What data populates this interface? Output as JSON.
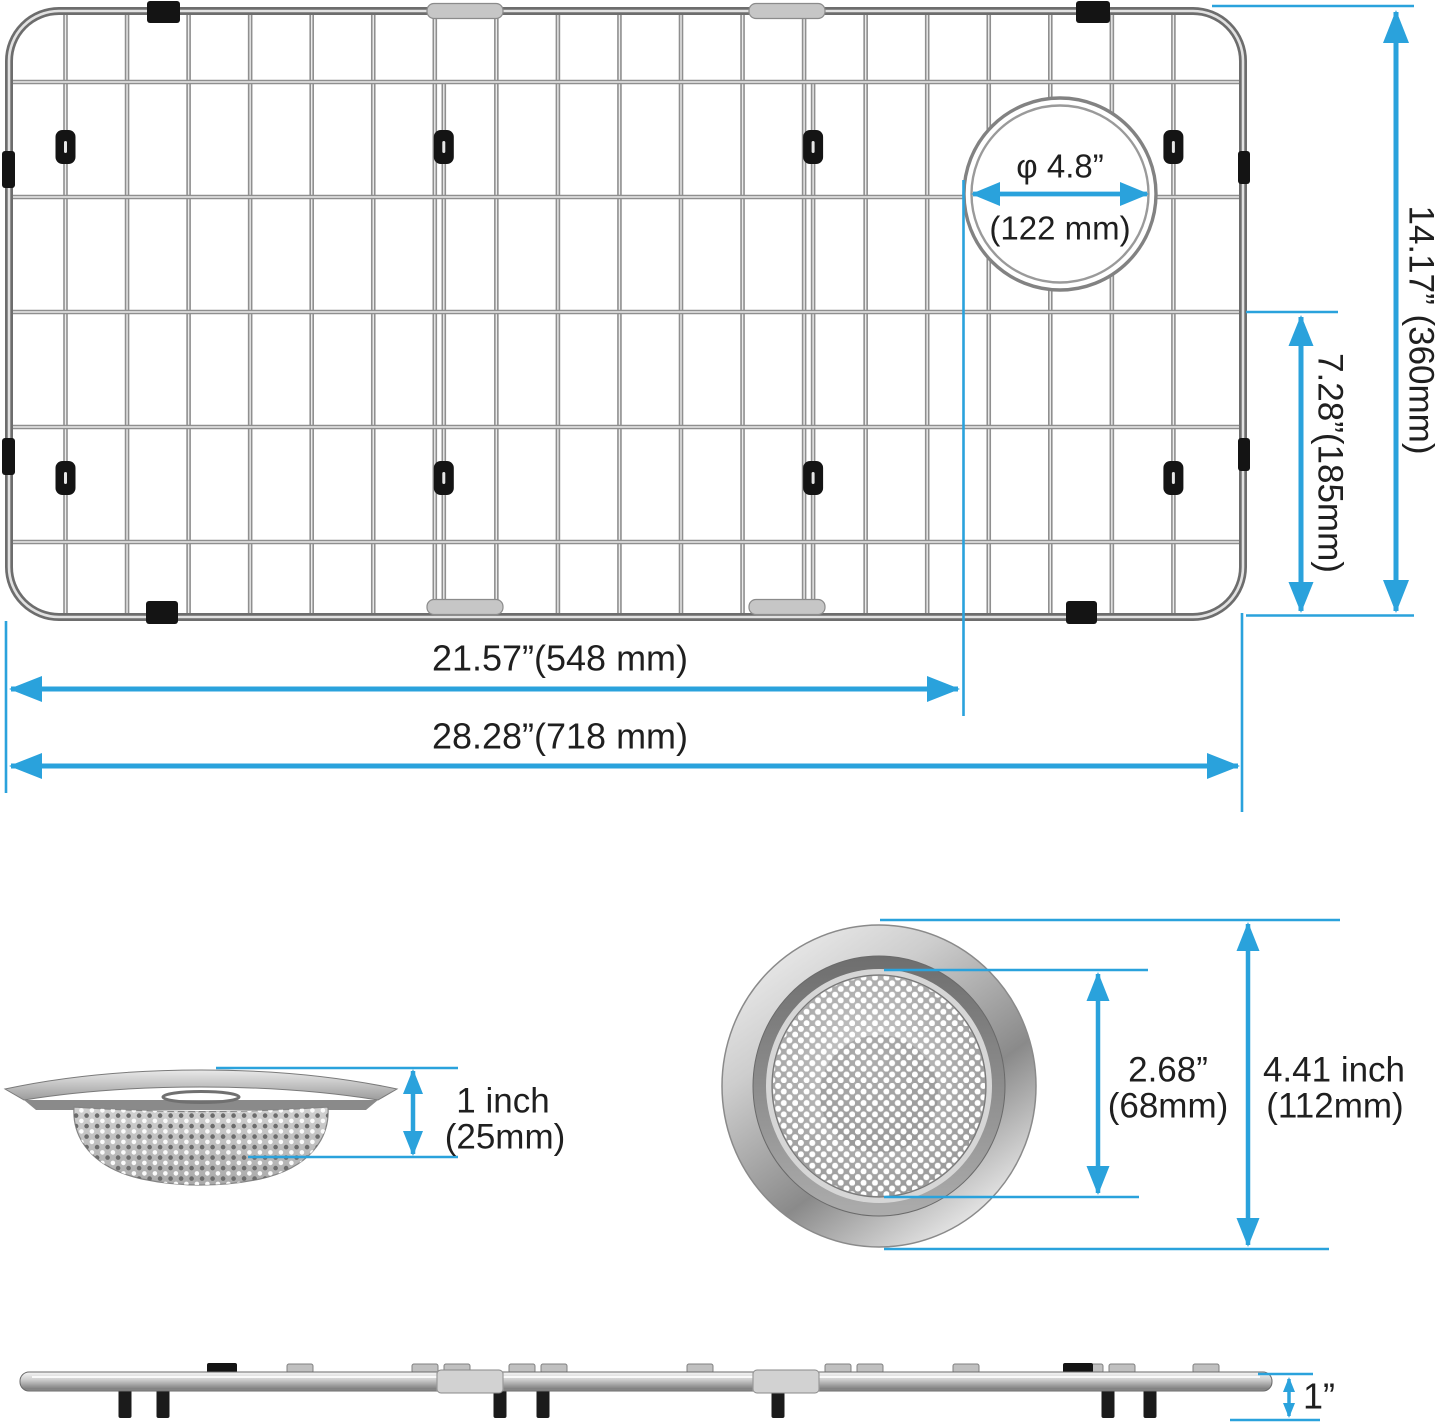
{
  "colors": {
    "dimension_blue": "#2AA2DC",
    "label_text": "#1f1f1f",
    "metal_gray": "#8f8f8f",
    "clip_black": "#141414"
  },
  "grid_view": {
    "hole_diameter_inch": "φ 4.8”",
    "hole_diameter_mm": "(122 mm)",
    "height": "14.17” (360mm)",
    "inner_height": "7.28”(185mm)",
    "drain_offset": "21.57”(548 mm)",
    "width": "28.28”(718 mm)"
  },
  "strainer_side": {
    "height_inch": "1 inch",
    "height_mm": "(25mm)"
  },
  "strainer_top": {
    "mesh_diameter_inch": "2.68”",
    "mesh_diameter_mm": "(68mm)",
    "outer_diameter_inch": "4.41 inch",
    "outer_diameter_mm": "(112mm)"
  },
  "profile": {
    "height": "1”"
  }
}
